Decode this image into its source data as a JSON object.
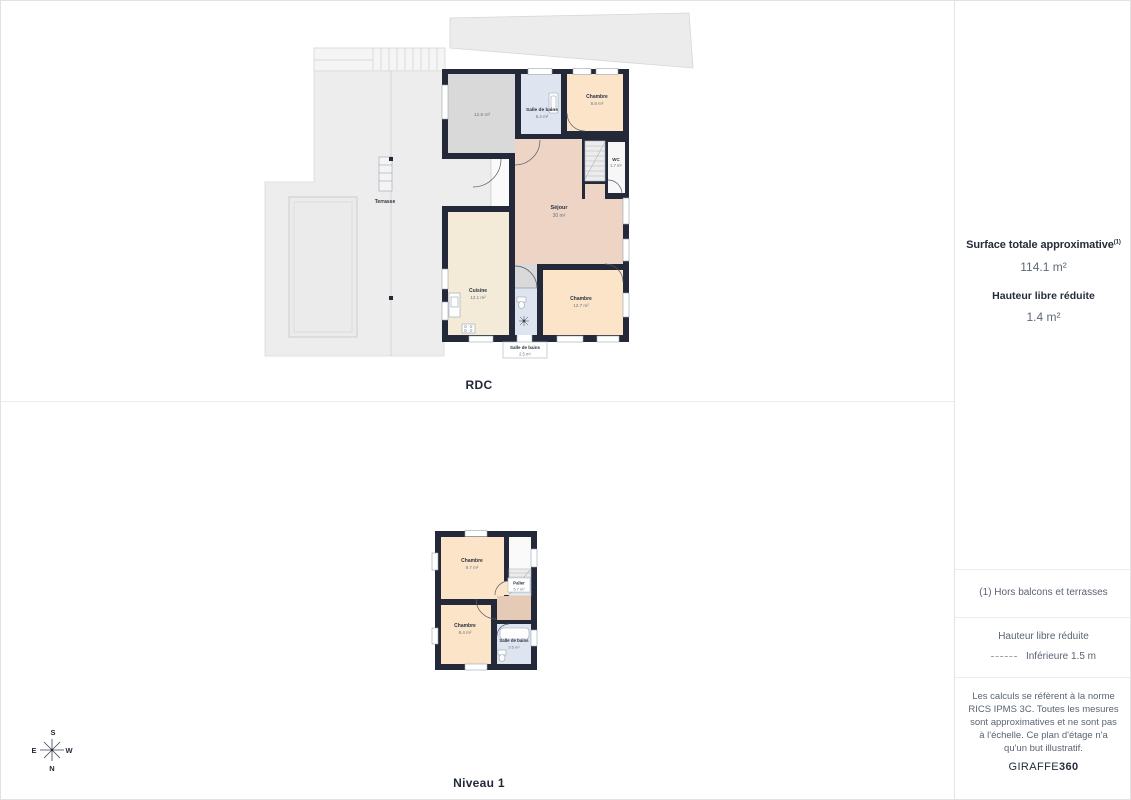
{
  "floors": {
    "rdc": {
      "label": "RDC",
      "terrasse_label": "Terrasse",
      "rooms": {
        "garage": {
          "name": "",
          "area": "12.5 m²"
        },
        "sdb1": {
          "name": "Salle de bains",
          "area": "6.4 m²"
        },
        "chambre1": {
          "name": "Chambre",
          "area": "8.8 m²"
        },
        "wc": {
          "name": "WC",
          "area": "1.7 m²"
        },
        "sejour": {
          "name": "Séjour",
          "area": "30 m²"
        },
        "cuisine": {
          "name": "Cuisine",
          "area": "12.1 m²"
        },
        "chambre2": {
          "name": "Chambre",
          "area": "12.7 m²"
        },
        "sdb2": {
          "name": "Salle de bains",
          "area": "2.5 m²"
        }
      }
    },
    "niveau1": {
      "label": "Niveau 1",
      "rooms": {
        "chambre1": {
          "name": "Chambre",
          "area": "9.7 m²"
        },
        "palier": {
          "name": "Palier",
          "area": "5.7 m²"
        },
        "chambre2": {
          "name": "Chambre",
          "area": "8.4 m²"
        },
        "sdb": {
          "name": "Salle de bains",
          "area": "3.6 m²"
        }
      }
    }
  },
  "compass": {
    "n": "N",
    "s": "S",
    "e": "E",
    "w": "W"
  },
  "sidebar": {
    "surface_title": "Surface totale approximative",
    "surface_sup": "(1)",
    "surface_value": "114.1 m²",
    "hauteur_title": "Hauteur libre réduite",
    "hauteur_value": "1.4 m²",
    "footnote": "(1) Hors balcons et terrasses",
    "legend_title": "Hauteur libre réduite",
    "legend_item": "Inférieure 1.5 m",
    "disclaimer": "Les calculs se réfèrent à la norme RICS IPMS 3C. Toutes les mesures sont approximatives et ne sont pas à l'échelle. Ce plan d'étage n'a qu'un but illustratif.",
    "brand_regular": "GIRAFFE",
    "brand_bold": "360"
  },
  "colors": {
    "wall": "#232939",
    "chambre": "#fbe4c8",
    "sejour": "#eed4c5",
    "cuisine": "#f3ebd7",
    "bains": "#dfe5f0",
    "garage": "#d9d9d9",
    "terrasse": "#ededed",
    "palier": "#e5cbb5"
  }
}
